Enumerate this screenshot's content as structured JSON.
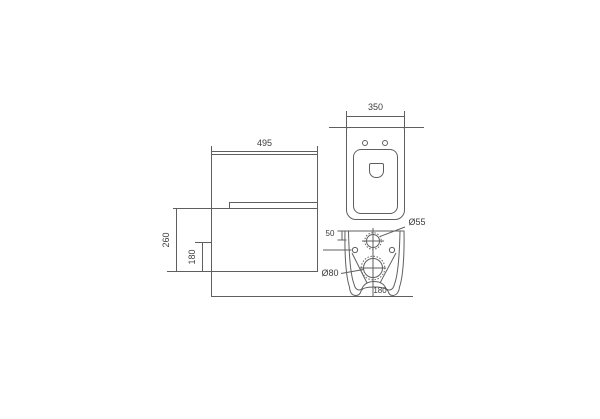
{
  "drawing": {
    "colors": {
      "background": "#ffffff",
      "line": "#5f5f5f",
      "text": "#3c3c3c"
    },
    "side_view": {
      "width": "495",
      "height_to_seat": "260",
      "outlet_height": "180"
    },
    "top_view": {
      "width": "350"
    },
    "back_view": {
      "inlet_offset_from_top": "50",
      "inlet_diameter": "Ø55",
      "outlet_diameter": "Ø80",
      "outlet_center_height": "180"
    }
  }
}
